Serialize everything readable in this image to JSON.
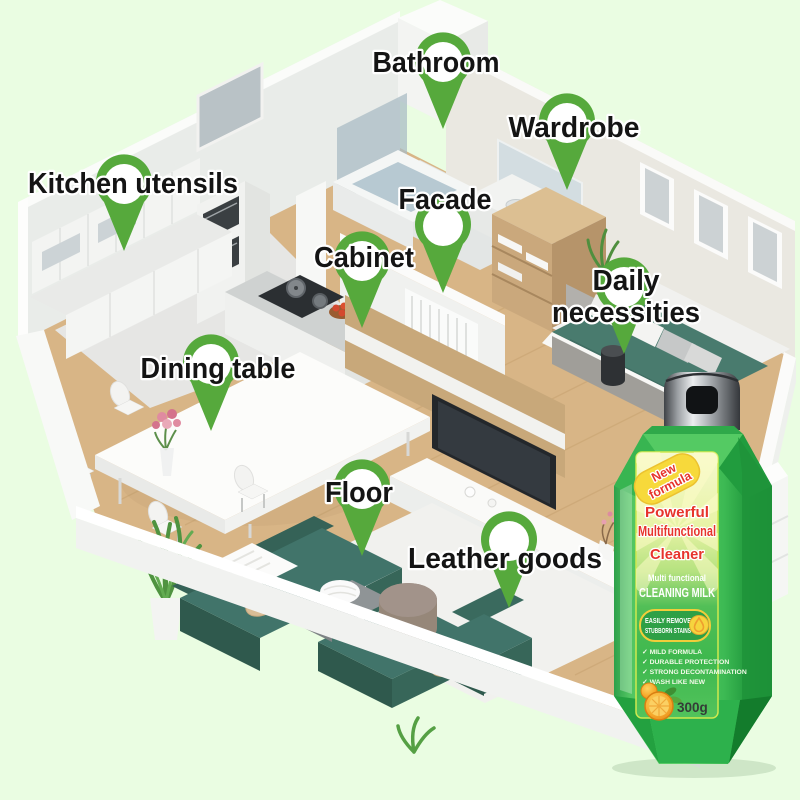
{
  "scene": {
    "background_color": "#eafde2",
    "pin_color": "#56a93c",
    "labels": {
      "bathroom": "Bathroom",
      "wardrobe": "Wardrobe",
      "kitchen_utensils": "Kitchen utensils",
      "facade": "Facade",
      "cabinet": "Cabinet",
      "daily_line1": "Daily",
      "daily_line2": "necessities",
      "dining_table": "Dining table",
      "floor": "Floor",
      "leather_goods": "Leather goods"
    }
  },
  "product": {
    "ribbon_line1": "New",
    "ribbon_line2": "formula",
    "headline_line1": "Powerful",
    "headline_line2": "Multifunctional",
    "headline_line3": "Cleaner",
    "type_small": "Multi functional",
    "type_big": "CLEANING MILK",
    "badge_line1": "EASILY REMOVE",
    "badge_line2": "STUBBORN STAINS",
    "features": [
      "✓ MILD FORMULA",
      "✓ DURABLE PROTECTION",
      "✓ STRONG DECONTAMINATION",
      "✓ WASH LIKE NEW"
    ],
    "weight": "300g",
    "colors": {
      "bottle_green": "#3cb953",
      "label_red": "#e7342c",
      "ribbon_yellow": "#f7d93b"
    }
  }
}
